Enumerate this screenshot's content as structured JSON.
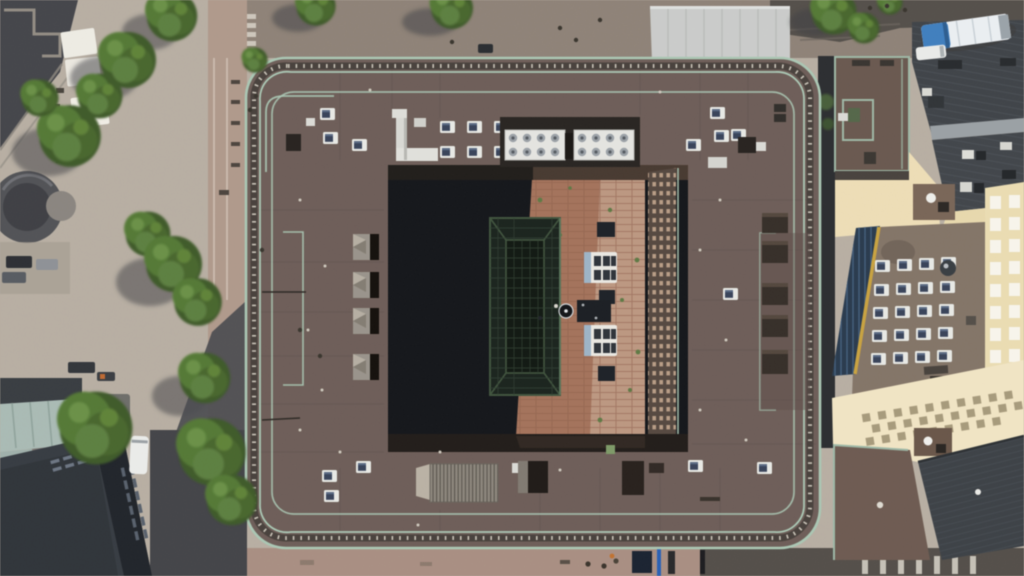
{
  "scene": {
    "type": "aerial-drone-photograph",
    "description": "Straight-down aerial view of a large square city-block building with an inner courtyard, copper-green roof parapets and rooftop HVAC units, flanked by a tree-lined pedestrian plaza on the left, streets on all sides, and neighboring rooftops with a yellow apartment facade at the far right.",
    "objects": [
      "central courtyard building with rounded corners and copper-green parapet railings",
      "rooftop walkways with tick-marked grating along the parapets",
      "two white HVAC fan banks with eight circular fans each",
      "white rooftop skylight boxes and ventilation ducts",
      "inner courtyard with red-brick paving, half in deep shadow",
      "gridded glass atrium skylight inside the courtyard",
      "white picnic tables and dark benches in the courtyard",
      "sunlit inner facade with dense window grid",
      "pedestrian plaza with trees, white market canopies and a circular fountain",
      "rows of parked cars and street furniture on the plaza",
      "dark high-rise roof with window slits at lower left",
      "pale glass entrance canopy at lower left",
      "white van parked on the shaded side street",
      "blue-and-white city bus on the upper-right street",
      "gray pavilion canopy along the top street",
      "pedestrian crosswalk stripes at upper left and lower right",
      "neighboring brown flat roof with railed enclosure at upper right",
      "dark gabled metal roofs with ridge ribs at the right",
      "flat roof with a grid of white skylights and a dark-blue glazed strip",
      "cream-yellow apartment facade with rows of white windows at far right",
      "ribbed dark roof and checkered glass canopy at lower right"
    ]
  },
  "palette": {
    "plaza_light": "#b7aea2",
    "plaza_shadow": "#4c4d51",
    "corner_dark": "#46474c",
    "street_top": "#8f8378",
    "road_dark": "#56514c",
    "street_pink": "#b0998b",
    "street_bottom": "#a98f82",
    "roof_main": "#6f5f59",
    "parapet_green": "#a9c6b3",
    "walkway_dark": "#4a433e",
    "courtyard_shadow": "#17191d",
    "courtyard_brick": "#a5735b",
    "courtyard_brick_light": "#c2a089",
    "courtyard_wall": "#574a42",
    "atrium_glass": "#1d2620",
    "atrium_frame": "#42553f",
    "skylight_white": "#e6e7e3",
    "hvac_platform": "#2b2724",
    "fan_gray": "#9aa0a6",
    "tree_green": "#4e7034",
    "canopy_white": "#eceae2",
    "glass_canopy": "#a9bab4",
    "dark_building": "#383d44",
    "neighbor_brown": "#6b5a50",
    "gable_dark": "#41454a",
    "cream_wall": "#ecdcb4",
    "skyroof_gray": "#847568",
    "glaze_blue": "#2b3c50",
    "glaze_edge_yellow": "#c9a23e",
    "facade_yellow": "#e9dbb0",
    "window_white": "#f6f3ea",
    "bus_blue": "#3f7fc1",
    "bus_white": "#e9edf0",
    "van_white": "#e9eae8"
  }
}
